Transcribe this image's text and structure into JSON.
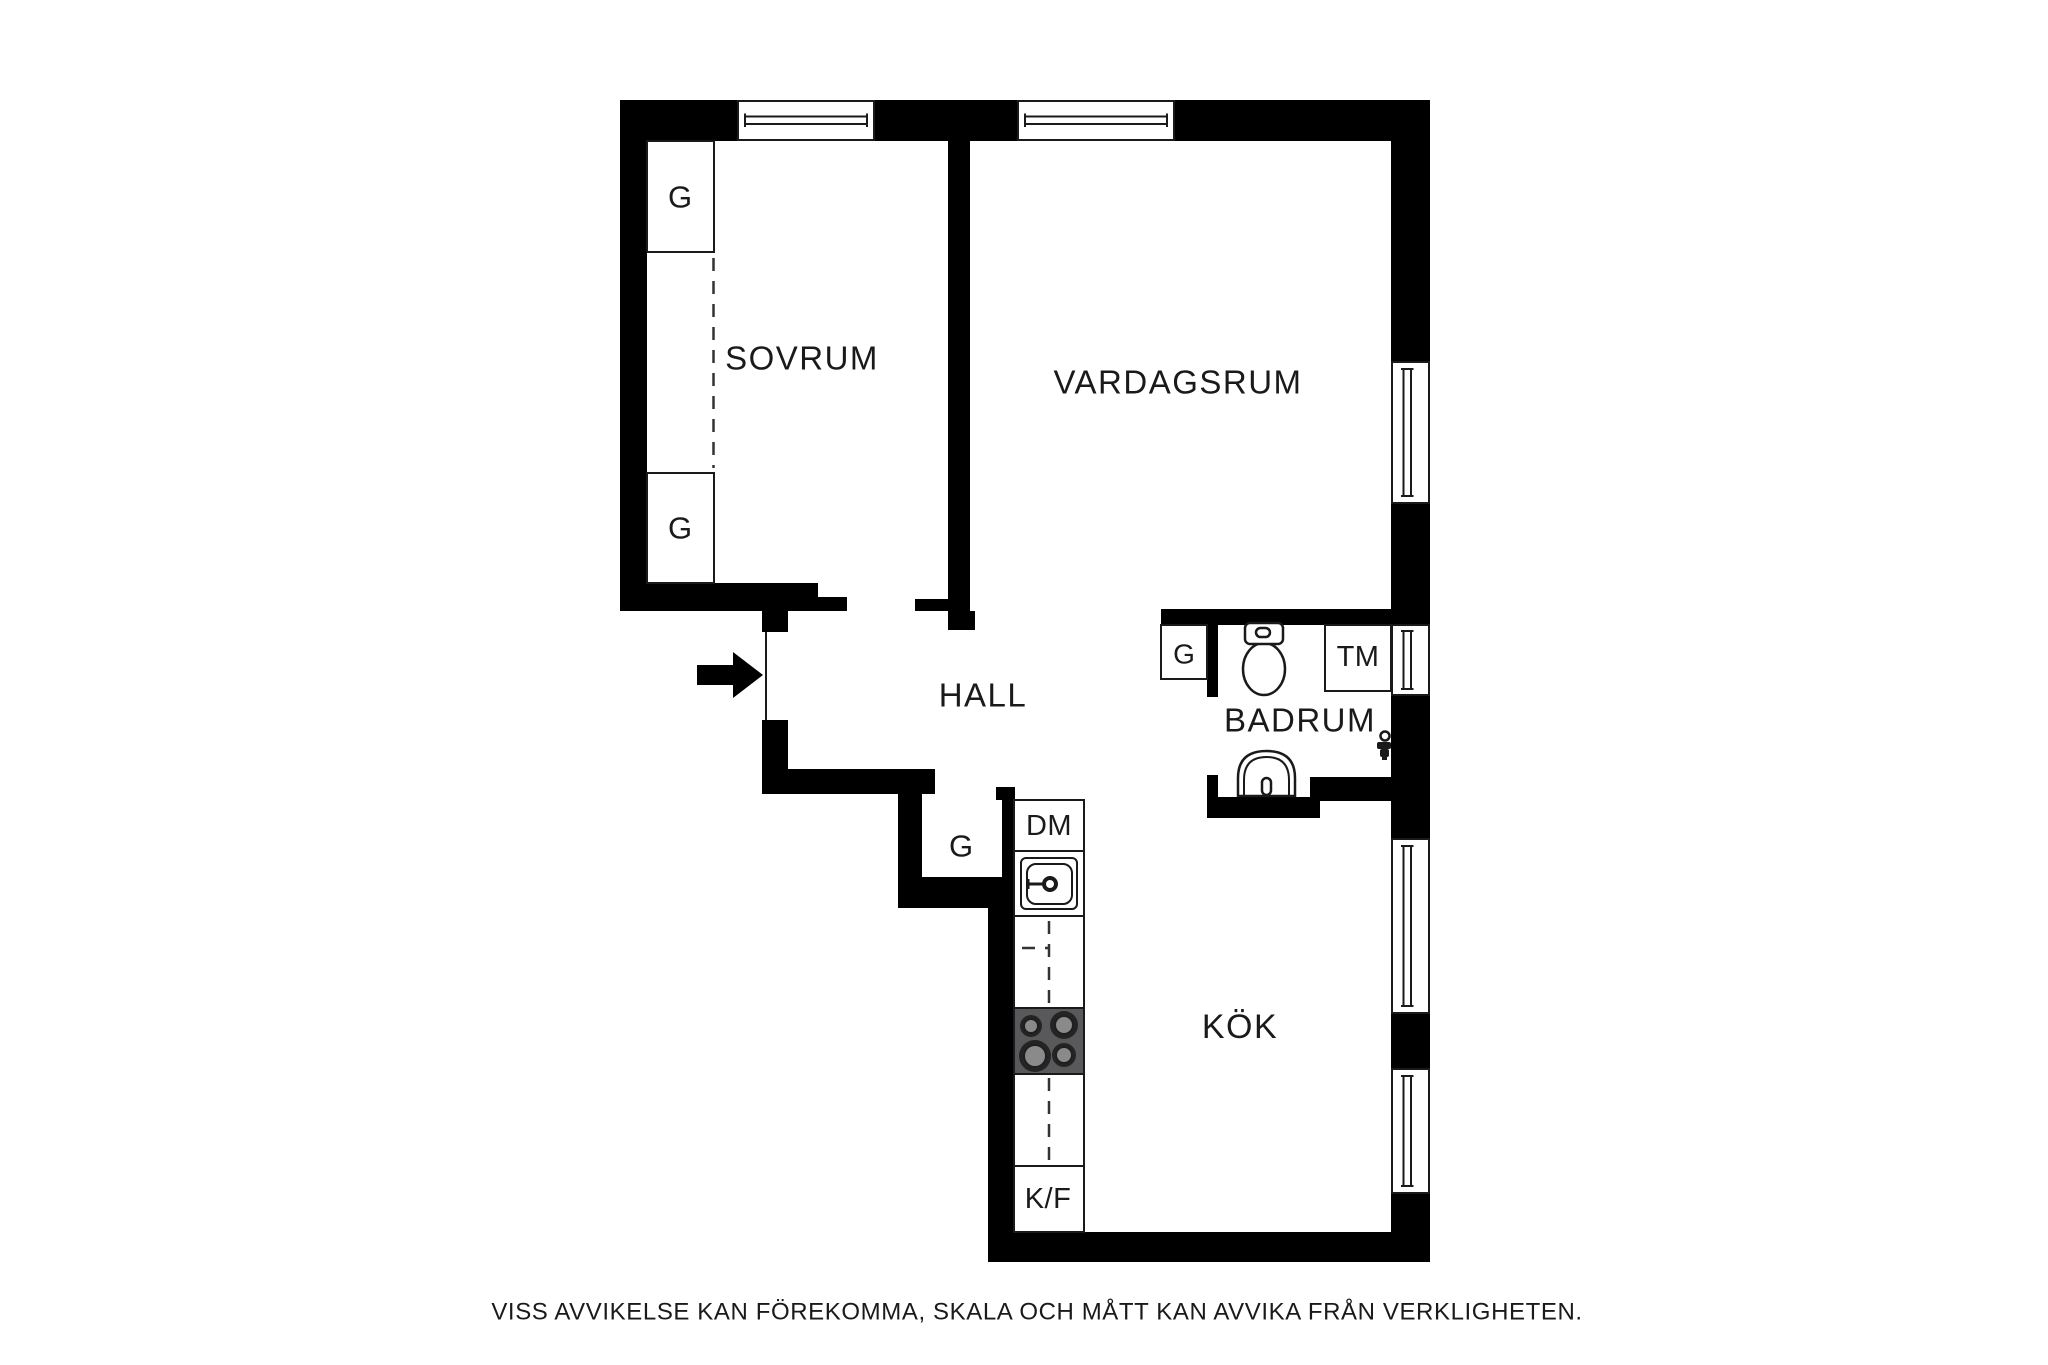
{
  "page": {
    "background": "#ffffff",
    "footer_text": "VISS AVVIKELSE KAN FÖREKOMMA, SKALA OCH MÅTT KAN AVVIKA FRÅN VERKLIGHETEN."
  },
  "floorplan": {
    "rooms": [
      {
        "id": "sovrum",
        "label": "SOVRUM"
      },
      {
        "id": "vardagsrum",
        "label": "VARDAGSRUM"
      },
      {
        "id": "hall",
        "label": "HALL"
      },
      {
        "id": "badrum",
        "label": "BADRUM"
      },
      {
        "id": "kok",
        "label": "KÖK"
      }
    ],
    "wardrobes": [
      {
        "id": "sovrum-upper",
        "label": "G"
      },
      {
        "id": "sovrum-lower",
        "label": "G"
      },
      {
        "id": "hall",
        "label": "G"
      },
      {
        "id": "badrum",
        "label": "G"
      }
    ],
    "appliances": {
      "washing_machine": "TM",
      "dishwasher": "DM",
      "fridge_freezer": "K/F"
    },
    "colors": {
      "wall": "#000000",
      "line": "#1a1a1a",
      "stove_body": "#59595b",
      "burner_outer": "#242424",
      "burner_inner": "#8a8a8a"
    }
  }
}
